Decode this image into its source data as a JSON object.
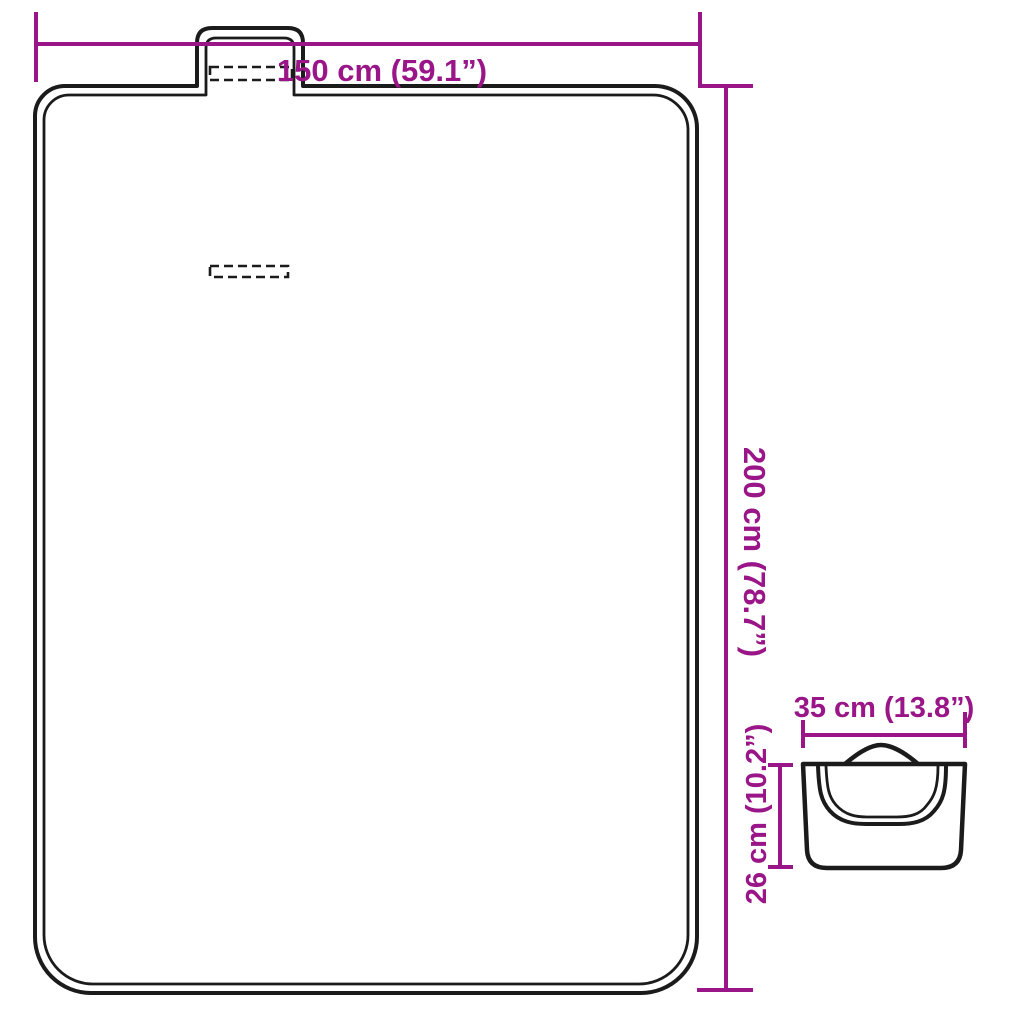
{
  "colors": {
    "dimension_accent": "#9a1588",
    "line_ink": "#1b1b1b",
    "background": "#ffffff"
  },
  "diagram": {
    "blanket": {
      "width_label": "150 cm (59.1”)",
      "height_label": "200 cm (78.7”)"
    },
    "folded_bag": {
      "width_label": "35 cm (13.8”)",
      "height_label": "26 cm (10.2”)"
    }
  }
}
